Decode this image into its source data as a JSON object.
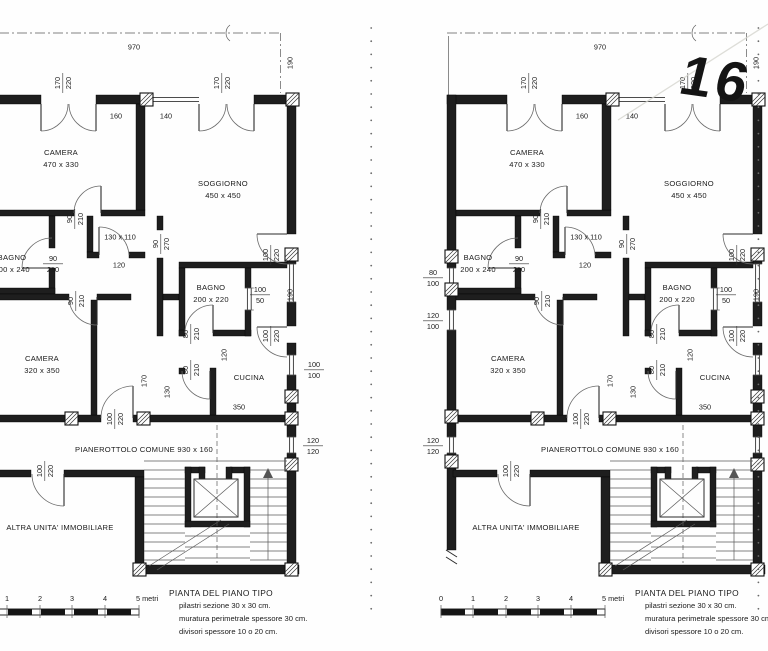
{
  "page": {
    "handwritten_number": "16"
  },
  "plan": {
    "annotations": [
      {
        "text": "970",
        "x": 153,
        "y": 47
      },
      {
        "num": "170",
        "den": "220",
        "x": 81,
        "y": 83,
        "rot": true
      },
      {
        "num": "170",
        "den": "220",
        "x": 240,
        "y": 83,
        "rot": true
      },
      {
        "text": "160",
        "x": 135,
        "y": 116
      },
      {
        "text": "140",
        "x": 185,
        "y": 116
      },
      {
        "text": "190",
        "x": 309,
        "y": 63,
        "rot": true
      },
      {
        "num": "90",
        "den": "210",
        "x": 93,
        "y": 219,
        "rot": true
      },
      {
        "text": "130 x 110",
        "x": 139,
        "y": 237
      },
      {
        "text": "120",
        "x": 138,
        "y": 265
      },
      {
        "num": "90",
        "den": "270",
        "x": 179,
        "y": 244,
        "rot": true
      },
      {
        "num": "90",
        "den": "210",
        "x": 72,
        "y": 263
      },
      {
        "num": "80",
        "den": "100",
        "x": -14,
        "y": 277
      },
      {
        "num": "120",
        "den": "100",
        "x": -14,
        "y": 320
      },
      {
        "num": "90",
        "den": "210",
        "x": 94,
        "y": 301,
        "rot": true
      },
      {
        "text": "170",
        "x": 163,
        "y": 381,
        "rot": true
      },
      {
        "num": "80",
        "den": "210",
        "x": 209,
        "y": 334,
        "rot": true
      },
      {
        "text": "120",
        "x": 243,
        "y": 355,
        "rot": true
      },
      {
        "num": "80",
        "den": "210",
        "x": 209,
        "y": 370,
        "rot": true
      },
      {
        "text": "130",
        "x": 186,
        "y": 392,
        "rot": true
      },
      {
        "num": "100",
        "den": "220",
        "x": 289,
        "y": 255,
        "rot": true
      },
      {
        "num": "100",
        "den": "50",
        "x": 279,
        "y": 294
      },
      {
        "text": "190",
        "x": 309,
        "y": 295,
        "rot": true
      },
      {
        "num": "100",
        "den": "220",
        "x": 289,
        "y": 336,
        "rot": true
      },
      {
        "num": "100",
        "den": "100",
        "x": 333,
        "y": 369
      },
      {
        "text": "350",
        "x": 258,
        "y": 407
      },
      {
        "num": "100",
        "den": "220",
        "x": 133,
        "y": 419,
        "rot": true
      },
      {
        "num": "120",
        "den": "120",
        "x": -14,
        "y": 445
      },
      {
        "num": "120",
        "den": "120",
        "x": 332,
        "y": 445
      },
      {
        "num": "100",
        "den": "220",
        "x": 63,
        "y": 471,
        "rot": true
      }
    ],
    "rooms": [
      {
        "name": "CAMERA",
        "size": "470 x 330",
        "x": 80,
        "y": 155
      },
      {
        "name": "SOGGIORNO",
        "size": "450 x 450",
        "x": 242,
        "y": 186
      },
      {
        "name": "BAGNO",
        "size": "200 x 240",
        "x": 31,
        "y": 260
      },
      {
        "name": "BAGNO",
        "size": "200 x 220",
        "x": 230,
        "y": 290
      },
      {
        "name": "CAMERA",
        "size": "320 x 350",
        "x": 61,
        "y": 361
      },
      {
        "name": "CUCINA",
        "size": "",
        "x": 268,
        "y": 380
      },
      {
        "name": "PIANEROTTOLO COMUNE 930 x 160",
        "size": "",
        "x": 163,
        "y": 452
      },
      {
        "name": "ALTRA UNITA' IMMOBILIARE",
        "size": "",
        "x": 79,
        "y": 530
      }
    ],
    "title": "PIANTA DEL PIANO TIPO",
    "notes": [
      "pilastri sezione 30 x 30 cm.",
      "muratura perimetrale spessore 30 cm.",
      "divisori spessore 10 o 20 cm."
    ],
    "scale_ticks": [
      {
        "label": "0",
        "x": -6
      },
      {
        "label": "1",
        "x": 26
      },
      {
        "label": "2",
        "x": 59
      },
      {
        "label": "3",
        "x": 91
      },
      {
        "label": "4",
        "x": 124
      },
      {
        "label": "5 metri",
        "x": 158
      }
    ]
  }
}
